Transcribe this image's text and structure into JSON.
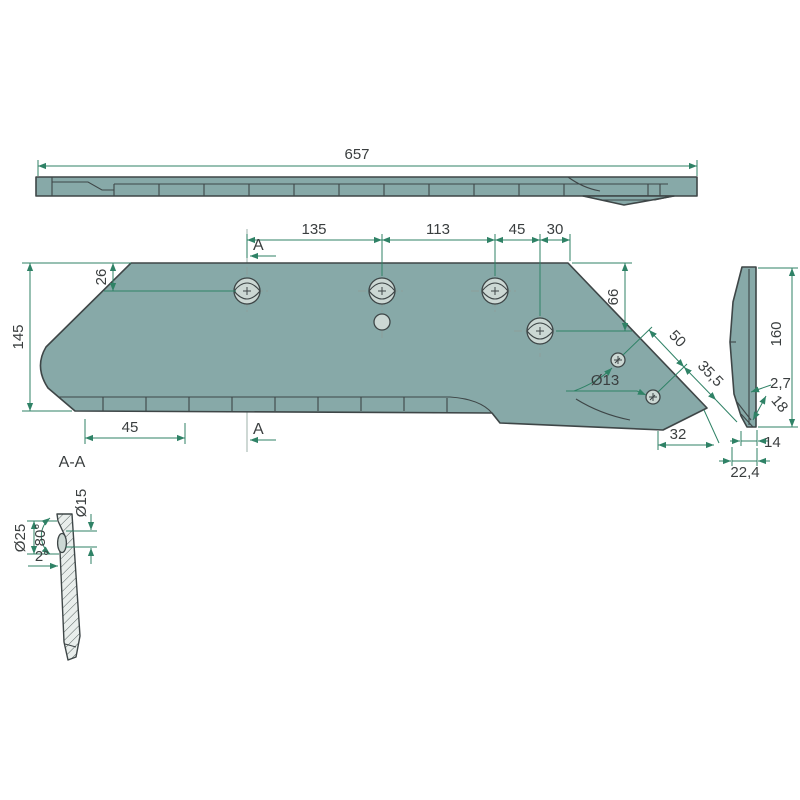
{
  "drawing": {
    "colors": {
      "part": "#87a9a8",
      "hole": "#ccd8d4",
      "outline": "#3e4647",
      "dimension": "#2f8266",
      "text": "#3a3e3f",
      "background": "#ffffff"
    },
    "top_view": {
      "length": "657"
    },
    "front_view": {
      "section_marker": "A",
      "hole_spacing_1": "135",
      "hole_spacing_2": "113",
      "hole_spacing_3": "45",
      "edge_offset": "30",
      "hole_top_offset": "26",
      "height": "145",
      "serration_length": "45",
      "wing_hole_offset": "66",
      "wing_spacing_1": "50",
      "wing_spacing_2": "35,5",
      "small_hole_dia": "Ø13",
      "tip_width": "32"
    },
    "side_view": {
      "height": "160",
      "edge_thickness": "2,7",
      "bevel_length": "18",
      "flat_width": "14",
      "total_width": "22,4"
    },
    "section_view": {
      "title": "A-A",
      "counterbore_dia": "Ø25",
      "countersink_angle": "80°",
      "hole_dia": "Ø15",
      "taper_angle": "2°"
    }
  }
}
